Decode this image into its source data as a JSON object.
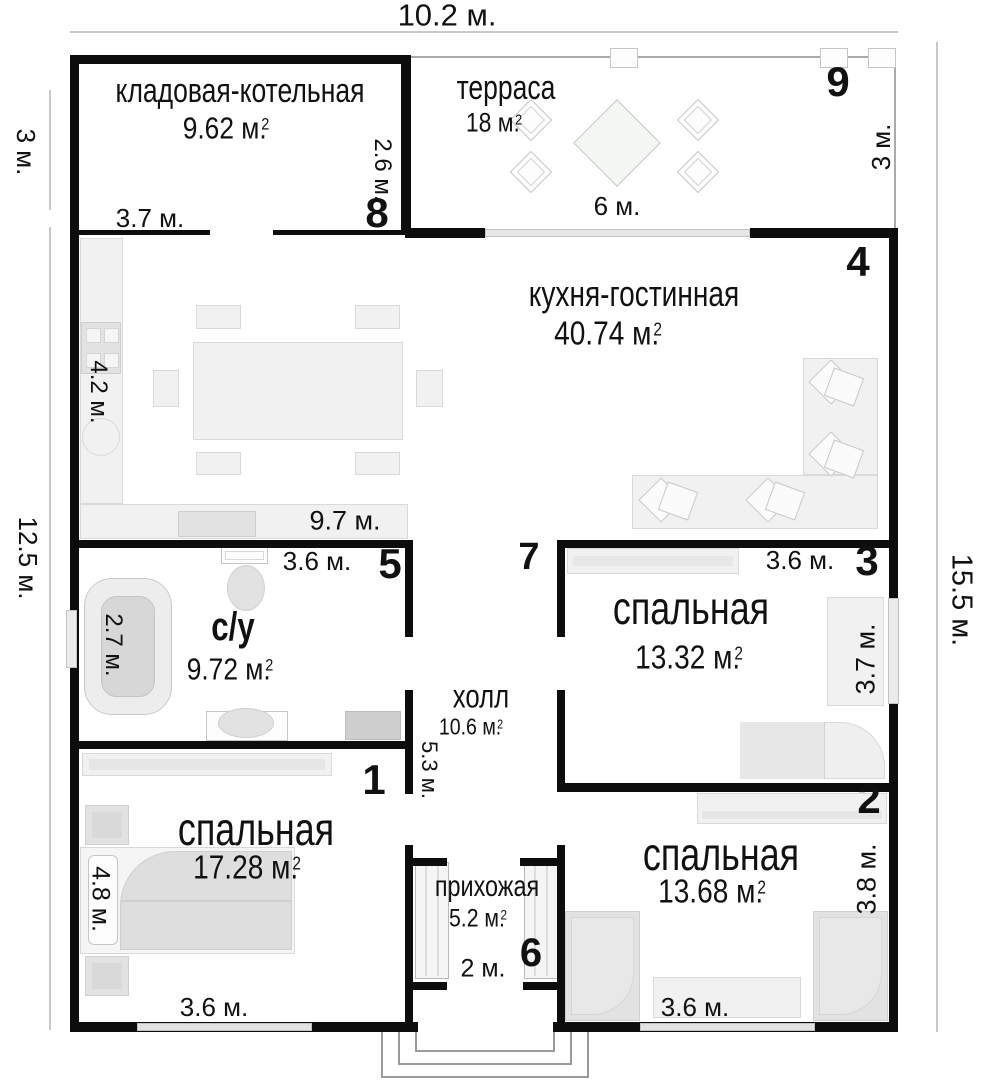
{
  "dims": {
    "top_width": "10.2 м.",
    "left_top": "3 м.",
    "left_main": "12.5 м.",
    "right_top": "3 м.",
    "right_main": "15.5 м."
  },
  "rooms": {
    "storage": {
      "name": "кладовая-котельная",
      "area": "9.62 м.",
      "sup": "2",
      "num": "8",
      "w": "3.7 м.",
      "h": "2.6 м."
    },
    "terrace": {
      "name": "терраса",
      "area": "18 м.",
      "sup": "2",
      "num": "9",
      "w": "6 м."
    },
    "kitchen": {
      "name": "кухня-гостинная",
      "area": "40.74 м.",
      "sup": "2",
      "num": "4",
      "w": "9.7 м.",
      "h": "4.2 м."
    },
    "bathroom": {
      "name": "с/у",
      "area": "9.72 м.",
      "sup": "2",
      "num": "5",
      "w": "3.6 м.",
      "h": "2.7 м."
    },
    "hall": {
      "name": "холл",
      "area": "10.6 м.",
      "sup": "2",
      "num": "7",
      "h": "5.3 м."
    },
    "bedroom3": {
      "name": "спальная",
      "area": "13.32 м.",
      "sup": "2",
      "num": "3",
      "w": "3.6 м.",
      "h": "3.7 м."
    },
    "bedroom1": {
      "name": "спальная",
      "area": "17.28 м.",
      "sup": "2",
      "num": "1",
      "w": "3.6 м.",
      "h": "4.8 м."
    },
    "bedroom2": {
      "name": "спальная",
      "area": "13.68 м.",
      "sup": "2",
      "num": "2",
      "w": "3.6 м.",
      "h": "3.8 м."
    },
    "entry": {
      "name": "прихожая",
      "area": "5.2 м.",
      "sup": "2",
      "num": "6",
      "w": "2 м."
    }
  }
}
